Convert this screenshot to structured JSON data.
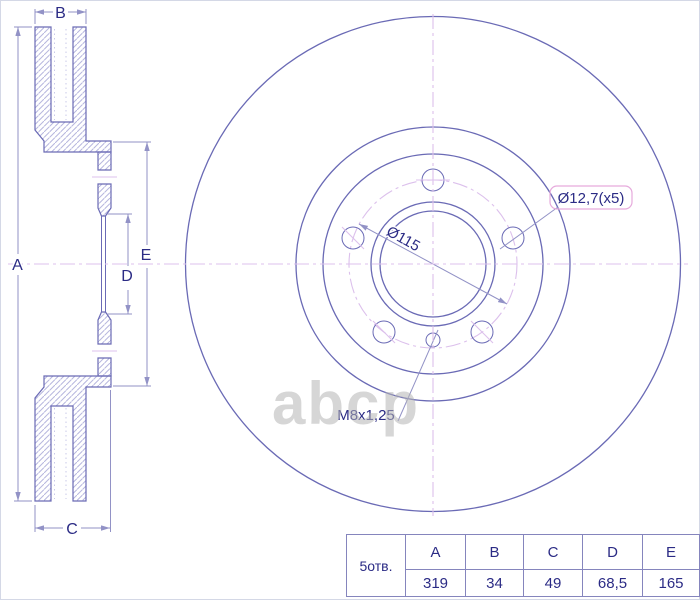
{
  "drawing": {
    "watermark": "abcp",
    "dim_labels": [
      "A",
      "B",
      "C",
      "D",
      "E"
    ],
    "annotations": {
      "bolt_holes": "Ø12,7(x5)",
      "pcd": "Ø115",
      "thread": "M8x1,25"
    },
    "colors": {
      "object_line": "#6a6ab5",
      "dimension_line": "#9292c6",
      "hatch": "#b6b6de",
      "centerline": "#dcc0ec",
      "text": "#2b2b85",
      "annotation_box": "#e6aadc",
      "watermark": "#b5b5b5",
      "table_border": "#8585bd"
    }
  },
  "table": {
    "holes_label": "5отв.",
    "columns": [
      "A",
      "B",
      "C",
      "D",
      "E"
    ],
    "values": [
      "319",
      "34",
      "49",
      "68,5",
      "165"
    ]
  }
}
